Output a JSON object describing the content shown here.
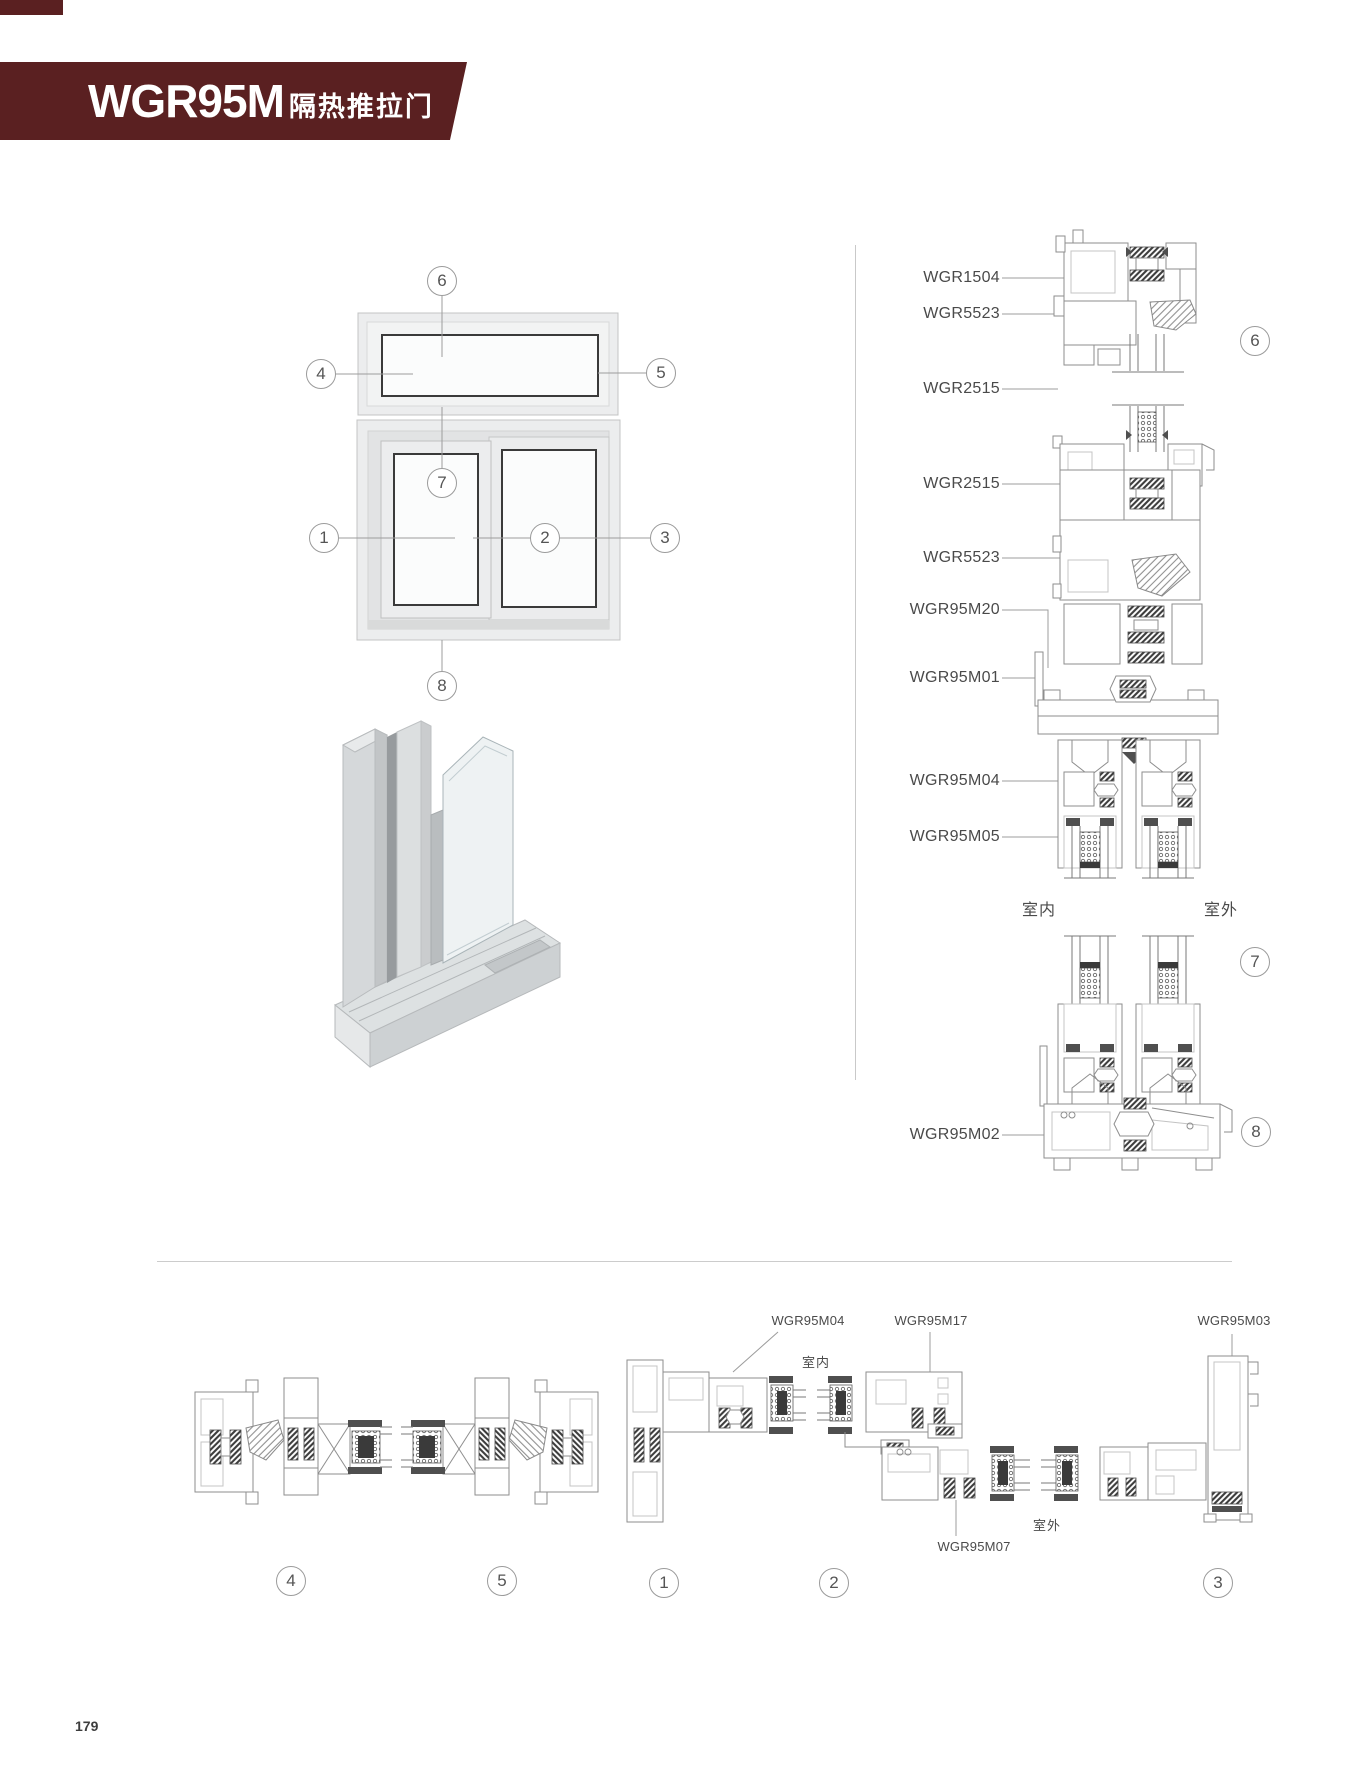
{
  "header": {
    "title": "WGR95M",
    "subtitle": "隔热推拉门",
    "accent_color": "#5a2021"
  },
  "elevation": {
    "callouts": [
      "1",
      "2",
      "3",
      "4",
      "5",
      "6",
      "7",
      "8"
    ]
  },
  "vertical_sections": {
    "part_labels": [
      "WGR1504",
      "WGR5523",
      "WGR2515",
      "WGR2515",
      "WGR5523",
      "WGR95M20",
      "WGR95M01",
      "WGR95M04",
      "WGR95M05",
      "WGR95M02"
    ],
    "indoor_label": "室内",
    "outdoor_label": "室外",
    "callouts": [
      "6",
      "7",
      "8"
    ]
  },
  "horizontal_sections": {
    "part_labels": [
      "WGR95M04",
      "WGR95M17",
      "WGR95M03",
      "WGR95M07"
    ],
    "indoor_label": "室内",
    "outdoor_label": "室外",
    "callouts": [
      "4",
      "5",
      "1",
      "2",
      "3"
    ]
  },
  "footer": {
    "page_number": "179"
  }
}
